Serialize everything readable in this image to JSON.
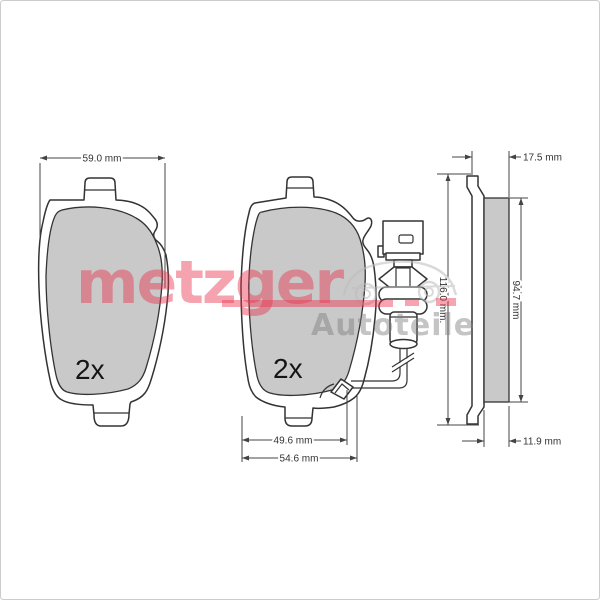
{
  "diagram": {
    "quantity_label": "2x",
    "dimensions": {
      "width_top": "59.0 mm",
      "bottom_inner": "49.6 mm",
      "bottom_outer": "54.6 mm",
      "overall_height": "116.0 mm.",
      "friction_height": "94.7 mm",
      "total_thickness": "17.5 mm",
      "friction_thickness": "11.9 mm"
    },
    "watermark": {
      "brand": "metzger",
      "line2": "Autoteile"
    },
    "colors": {
      "pad_fill": "#c9c9c9",
      "line": "#333333",
      "watermark_red": "#e8364f",
      "watermark_gray": "#7d7d7d"
    }
  }
}
